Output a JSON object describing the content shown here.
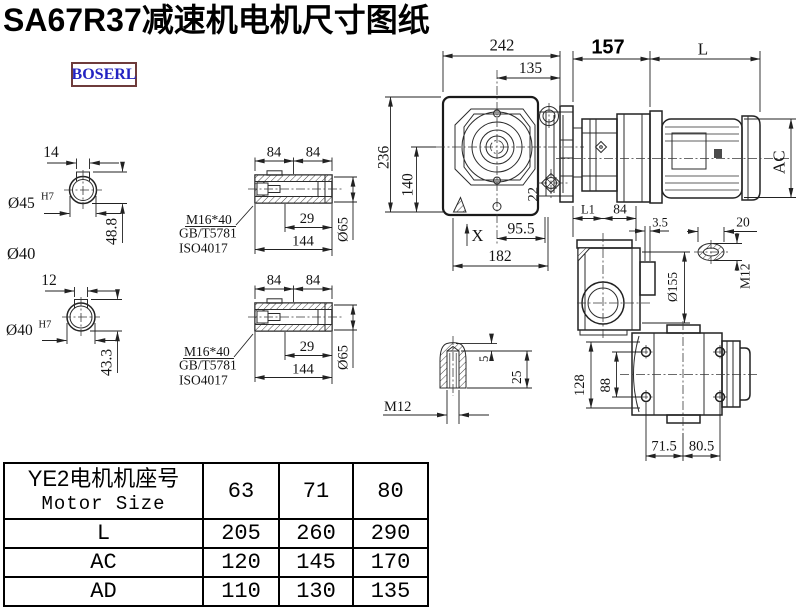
{
  "page": {
    "title": "SA67R37减速机电机尺寸图纸",
    "logo": "BOSERL"
  },
  "views": {
    "shaft45": {
      "keyway": "14",
      "bore": "Ø45",
      "tol": "H7",
      "height": "48.8",
      "od": "Ø40"
    },
    "shaft40": {
      "keyway": "12",
      "bore": "Ø40",
      "tol": "H7",
      "height": "43.3"
    },
    "hollow": {
      "a": "84",
      "b": "84",
      "screw": "M16*40",
      "std1": "GB/T5781",
      "std2": "ISO4017",
      "depth": "29",
      "len": "144",
      "dia": "Ø65"
    },
    "front": {
      "width": "242",
      "half": "135",
      "height": "236",
      "center_h": "140",
      "plug": "22",
      "view_label": "X",
      "foot1": "95.5",
      "foot2": "182"
    },
    "motor": {
      "gear_len": "157",
      "motor_len": "L",
      "dia": "AC",
      "l1": "L1",
      "c": "84"
    },
    "side": {
      "gap": "3.5",
      "flange": "Ø155"
    },
    "slot": {
      "len": "20",
      "thread": "M12"
    },
    "key": {
      "cap": "5",
      "depth": "25",
      "thread": "M12"
    },
    "bottom": {
      "h": "128",
      "bolt_h": "88",
      "p1": "71.5",
      "p2": "80.5"
    }
  },
  "table": {
    "header": {
      "title_cn": "YE2电机机座号",
      "title_en": "Motor Size",
      "sizes": [
        "63",
        "71",
        "80"
      ]
    },
    "rows": [
      {
        "label": "L",
        "values": [
          "205",
          "260",
          "290"
        ]
      },
      {
        "label": "AC",
        "values": [
          "120",
          "145",
          "170"
        ]
      },
      {
        "label": "AD",
        "values": [
          "110",
          "130",
          "135"
        ]
      }
    ]
  }
}
